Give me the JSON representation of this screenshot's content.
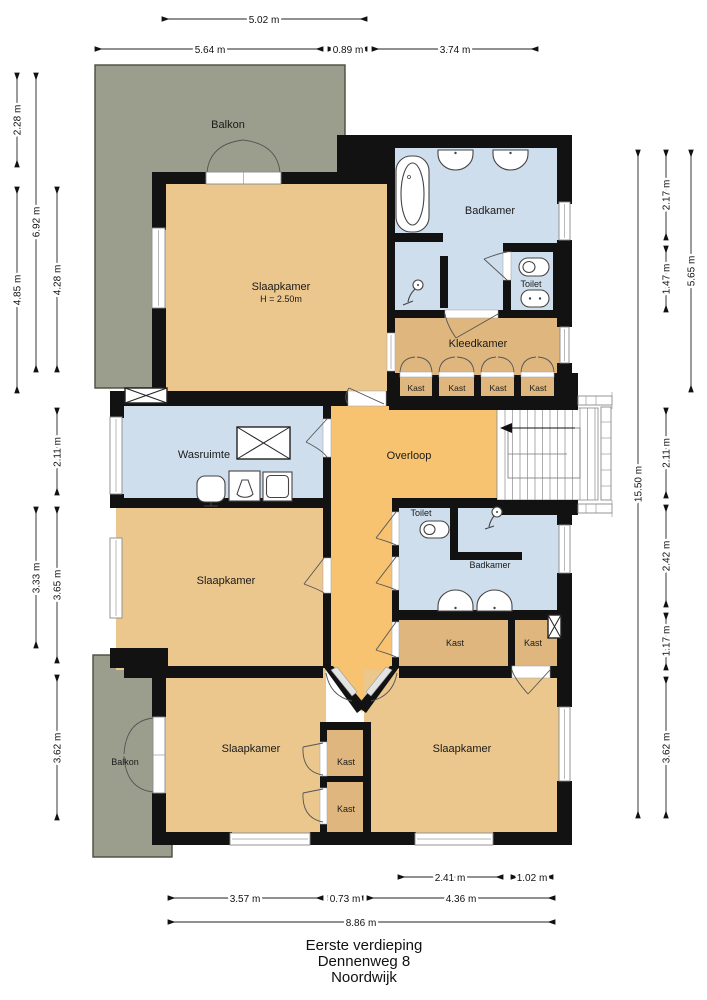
{
  "title": {
    "floor": "Eerste verdieping",
    "street": "Dennenweg 8",
    "city": "Noordwijk"
  },
  "rooms": {
    "balkon_top": "Balkon",
    "slaapkamer_tl": "Slaapkamer",
    "slaapkamer_tl_h": "H = 2.50m",
    "badkamer_top": "Badkamer",
    "toilet_top": "Toilet",
    "kleedkamer": "Kleedkamer",
    "kast_a": "Kast",
    "kast_b": "Kast",
    "kast_c": "Kast",
    "kast_d": "Kast",
    "wasruimte": "Wasruimte",
    "overloop": "Overloop",
    "slaapkamer_mid": "Slaapkamer",
    "toilet_mid": "Toilet",
    "badkamer_mid": "Badkamer",
    "kast_e": "Kast",
    "kast_f": "Kast",
    "balkon_bottom": "Balkon",
    "slaapkamer_bl": "Slaapkamer",
    "kast_g": "Kast",
    "kast_h": "Kast",
    "slaapkamer_br": "Slaapkamer"
  },
  "dims": {
    "top": [
      "5.02 m",
      "5.64 m",
      "0.89 m",
      "3.74 m"
    ],
    "left": [
      "2.28 m",
      "6.92 m",
      "4.85 m",
      "4.28 m",
      "2.11 m",
      "3.33 m",
      "3.65 m",
      "3.62 m"
    ],
    "right": [
      "2.17 m",
      "5.65 m",
      "1.47 m",
      "2.11 m",
      "15.50 m",
      "2.42 m",
      "1.17 m",
      "3.62 m"
    ],
    "bottom": [
      "2.41 m",
      "1.02 m",
      "3.57 m",
      "0.73 m",
      "4.36 m",
      "8.86 m"
    ]
  },
  "colors": {
    "bedroom": "#ebc78d",
    "hallway": "#f7c371",
    "closet": "#dfb77e",
    "wet": "#cfdeed",
    "balcony": "#9c9e8d",
    "wall": "#121212"
  }
}
